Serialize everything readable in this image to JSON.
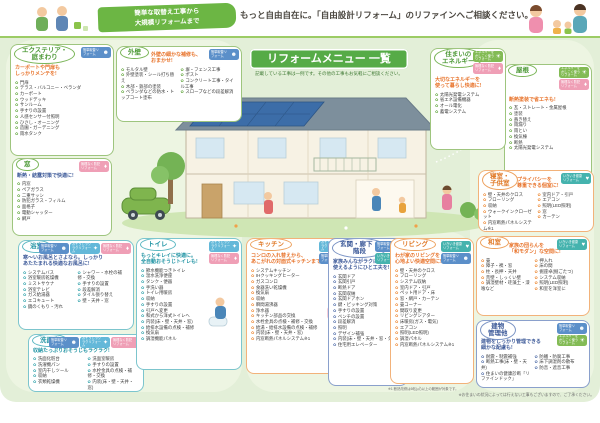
{
  "header": {
    "ribbon": "簡単な取替え工事から\n大規模リフォームまで",
    "headline": "もっと自由自在に。「自由設計リフォーム」のリファインへご相談ください。"
  },
  "banner": {
    "title": "リフォームメニュー 一覧",
    "subtitle": "記載している工事は一例です。その他の工事もお気軽にご相談ください。"
  },
  "footnotes": {
    "living": "※1 断熱改修は6帖(㎡)以上の範囲が対象です。",
    "bottom": "※お住まいの状況によっては行えない工事もございますので、ご了承ください。"
  },
  "ui": {
    "bullet": "✿"
  },
  "badges": {
    "petit": {
      "label": "簡単取替リフォーム",
      "color": "#5b8fc9",
      "glyph": "☻",
      "icon": "family-icon"
    },
    "souji": {
      "label": "おそうじラクラクリフォーム",
      "color": "#63b8d9",
      "glyph": "✦",
      "icon": "sparkle-icon"
    },
    "bouhan": {
      "label": "無理なく防犯リフォーム",
      "color": "#ef9fb6",
      "glyph": "♦",
      "icon": "bag-icon"
    },
    "energy": {
      "label": "エネルギーをかしこく使うリフォーム",
      "color": "#83bb55",
      "glyph": "☀",
      "icon": "sun-icon"
    },
    "kenko": {
      "label": "いきいき健康リフォーム",
      "color": "#45b3ae",
      "glyph": "♥",
      "icon": "heart-icon"
    }
  },
  "sections": {
    "exterior": {
      "title": "エクステリア・\n庭まわり",
      "tagline": "カーポートや門扉も\nしっかりメンテを!",
      "badges": [
        "petit"
      ],
      "items": [
        "門扉",
        "テラス・バルコニー・ベランダ",
        "カーポート",
        "ウッドデッキ",
        "サンルーム",
        "手すりの設置",
        "人感センサー付照明",
        "ひさし・オーニング",
        "造園・ガーデニング",
        "雨水タンク"
      ]
    },
    "gaiheki": {
      "title": "外壁",
      "tagline": "外壁の細かな補修も、\nおまかせ!",
      "badges": [
        "petit"
      ],
      "cols": [
        [
          "モルタル壁",
          "外壁塗装・シール打ち替え",
          "木部・鉄部の塗装",
          "ベランダなどの防水・トップコート塗布"
        ],
        [
          "塀・フェンス工事",
          "ポスト",
          "コンクリート工事・タイル工事",
          "スロープなどの段差解消"
        ]
      ]
    },
    "mado": {
      "title": "窓",
      "tagline": "断熱・結露対策で快適に!",
      "badges": [
        "bouhan"
      ],
      "items": [
        "内窓",
        "ペアガラス",
        "二重サッシ",
        "防犯ガラス・フィルム",
        "面格子",
        "電動シャッター",
        "網戸"
      ]
    },
    "yokushitsu": {
      "title": "浴室",
      "tagline": "寒〜いお風呂とさよなら。しっかり\nあたたまれる快適なお風呂に!",
      "badges": [
        "petit",
        "souji",
        "bouhan"
      ],
      "cols": [
        [
          "システムバス",
          "浴室暖房乾燥機",
          "ミストサウナ",
          "浴室テレビ",
          "ガス給湯器",
          "エコキュート",
          "鏡のくもり・汚れ"
        ],
        [
          "シャワー・水栓の補修・交換",
          "手すりの設置",
          "段差解消",
          "タイル張り替え",
          "壁・天井・窓"
        ]
      ]
    },
    "senmen": {
      "title": "洗面室",
      "tagline": "収納たっぷりおそうじもラクラク!",
      "badges": [
        "petit",
        "souji",
        "bouhan"
      ],
      "cols": [
        [
          "洗面化粧台",
          "洗濯機パン",
          "室内干しツール",
          "収納",
          "衣類乾燥機"
        ],
        [
          "洗面室暖房",
          "手すりの設置",
          "水栓金具の点検・補修・交換",
          "内装(床・壁・天井・窓)",
          "給湯・給排水設備の点検・補修"
        ]
      ]
    },
    "toilet": {
      "title": "トイレ",
      "tagline": "もっとキレイに快適に。\n全自動おそうじトイレも!",
      "badges": [
        "souji",
        "bouhan"
      ],
      "items": [
        "節水機能つきトイレ",
        "温水洗浄便座",
        "タンク・便器",
        "手洗い器",
        "トイレ用暖房",
        "収納",
        "手すりの設置",
        "引戸へ変更",
        "和式から洋式トイレへ",
        "内装(床・壁・天井・窓)",
        "給排水設備の点検・補修",
        "換気扇",
        "調湿機能パネル"
      ]
    },
    "kitchen": {
      "title": "キッチン",
      "tagline": "コンロの入れ替えから、\nあこがれの対面式キッチンまで!",
      "badges": [
        "souji",
        "petit"
      ],
      "items": [
        "システムキッチン",
        "IHクッキングヒーター",
        "ガスコンロ",
        "食器洗い乾燥機",
        "換気扇",
        "収納",
        "瞬間湯沸器",
        "浄水器",
        "キッチン部品の交換",
        "水栓金具の点検・補修・交換",
        "給湯・給排水設備の点検・補修",
        "内装(床・壁・天井・窓)",
        "内窓断熱パネルシステム※1"
      ]
    },
    "genkan": {
      "title": "玄関・廊下・\n階段",
      "tagline": "家族みんながラクに\n使えるようにひと工夫を!",
      "badges": [
        "petit",
        "kenko"
      ],
      "items": [
        "玄関ドア",
        "玄関引戸",
        "断熱ドア",
        "玄関収納",
        "玄関ドアホン",
        "鍵・ピッキング対策",
        "手すりの設置",
        "ベンチの設置",
        "段差解消",
        "照明",
        "デザイン補強",
        "内装(床・壁・天井・窓・タイル)",
        "住宅用エレベーター"
      ]
    },
    "living": {
      "title": "リビング",
      "tagline": "わが家のリビングを\n心地よい快適空間に!",
      "badges": [
        "kenko",
        "petit"
      ],
      "items": [
        "壁・天井のクロス",
        "フローリング",
        "システム収納",
        "室内ドア・引戸",
        "ペット用ドア・床",
        "窓・網戸・カーテン",
        "畳コーナー",
        "間取り変更",
        "リビングシアター",
        "床暖房(ガス・電気)",
        "エアコン",
        "照明(LED照明)",
        "調湿パネル",
        "内窓断熱パネルシステム※1"
      ]
    },
    "washitsu": {
      "title": "和室",
      "tagline": "家族の団らんを\n「和モダン」な空間に!",
      "badges": [
        "kenko"
      ],
      "cols": [
        [
          "畳",
          "障子・襖・窓",
          "柱・長押・天井",
          "荒壁・しっくい壁",
          "調湿壁材・珪藻土・漆喰など"
        ],
        [
          "押入れ",
          "床の間",
          "掘座卓(掘ごたつ)",
          "システム収納",
          "照明(LED照明)",
          "和室を洋室に"
        ]
      ]
    },
    "yane": {
      "title": "屋根",
      "tagline": "断熱塗装で省エネも!",
      "badges": [
        "energy",
        "bouhan"
      ],
      "items": [
        "瓦・ストレート・金属屋根",
        "塗装",
        "葺き替え",
        "雨漏り",
        "雨とい",
        "換気棟",
        "断熱",
        "太陽光発電システム"
      ]
    },
    "shinshitsu": {
      "title": "寝室・\n子供室",
      "tagline": "プライバシーを\n尊重できる個室に!",
      "badges": [
        "kenko"
      ],
      "cols": [
        [
          "壁・天井のクロス",
          "フローリング",
          "収納",
          "ウォークインクローゼット",
          "内窓断熱パネルシステム※1"
        ],
        [
          "室内ドア・引戸",
          "エアコン",
          "照明(LED照明)",
          "窓",
          "カーテン"
        ]
      ]
    },
    "energy": {
      "title": "住まいの\nエネルギー",
      "tagline": "大切なエネルギーを\n使って暮らし快適に!",
      "badges": [
        "energy",
        "bouhan"
      ],
      "items": [
        "太陽光発電システム",
        "省エネ設備機器",
        "オール電化",
        "蓄電システム"
      ]
    },
    "tatemono": {
      "title": "建物\n管理他",
      "tagline": "建物をしっかり管理できる\n細かな配慮も!",
      "badges": [
        "petit",
        "energy"
      ],
      "cols": [
        [
          "耐震・制震補強",
          "断熱工事(床・壁・天井)",
          "住まいの健康診断「リファインドック」"
        ],
        [
          "防蟻・防腐工事",
          "床下調湿剤の散布",
          "防音・遮音工事"
        ]
      ]
    }
  }
}
